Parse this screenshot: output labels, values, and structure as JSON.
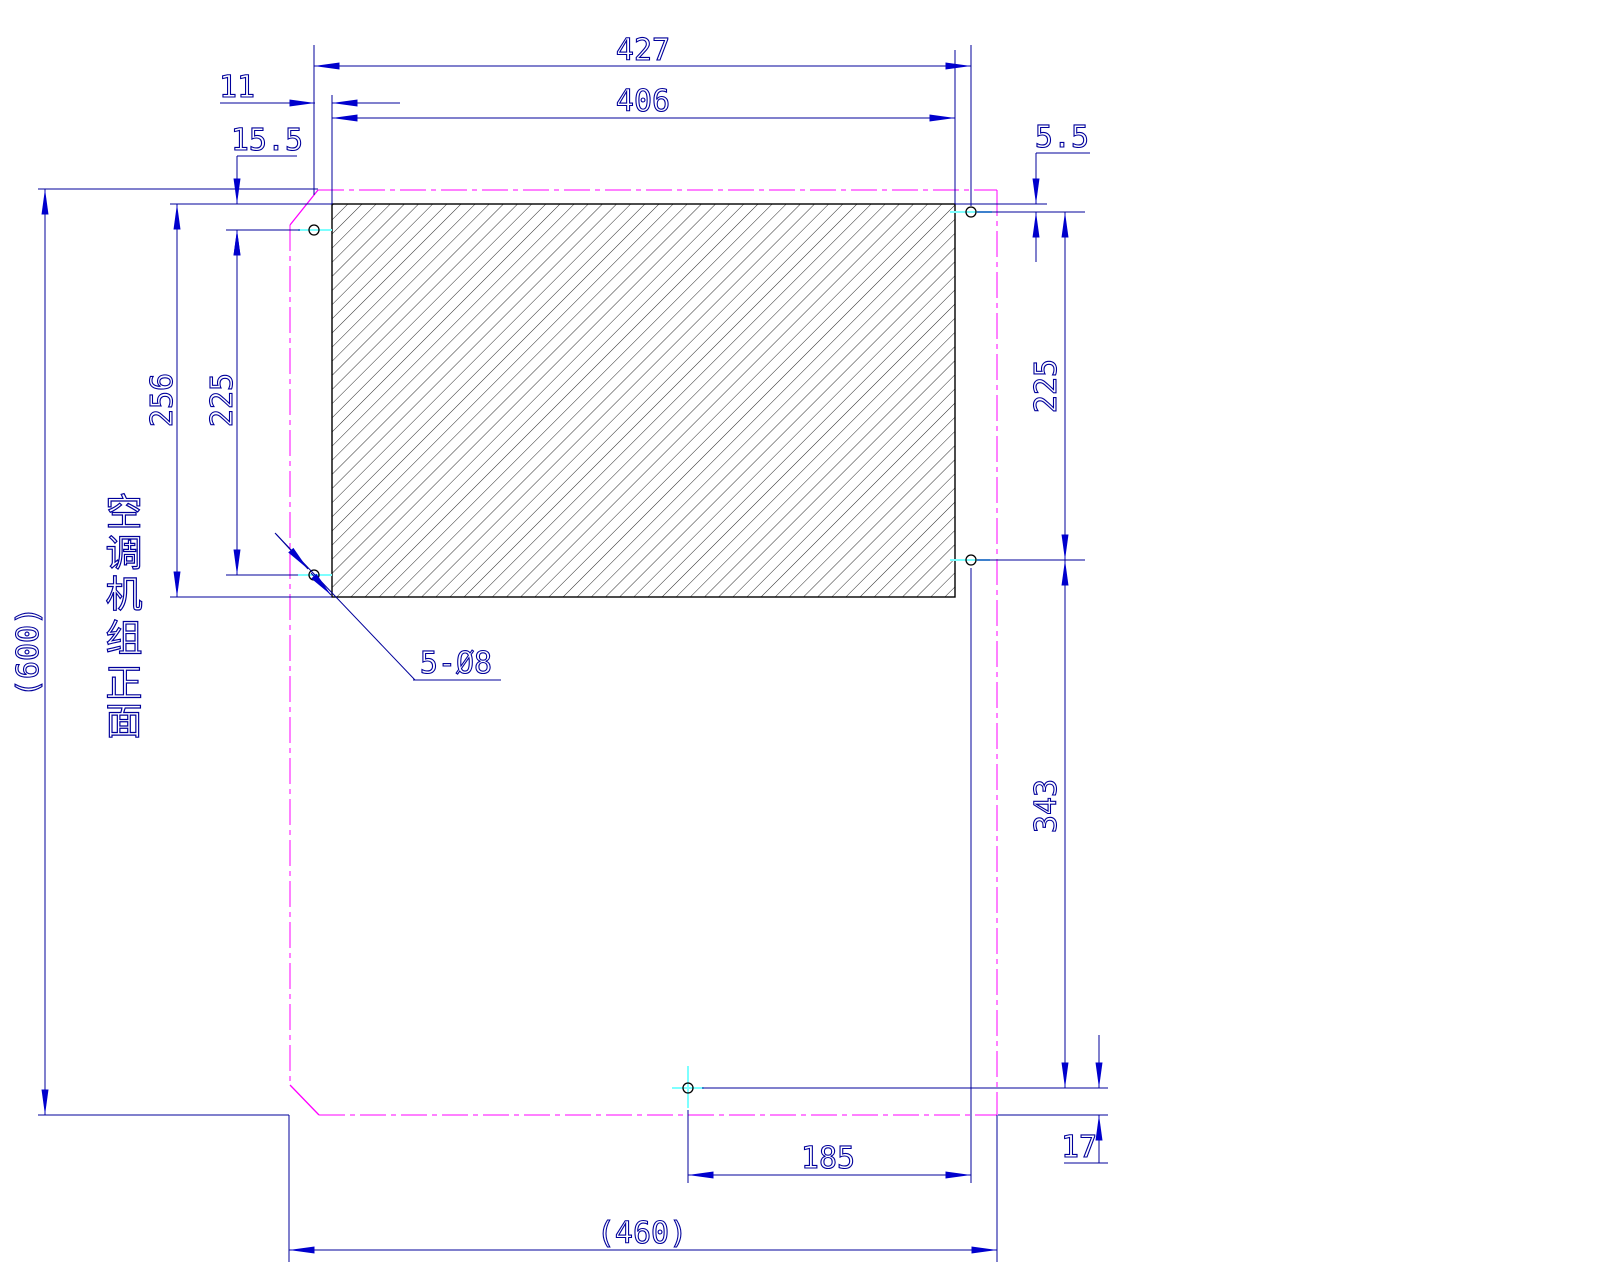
{
  "colors": {
    "dimension": "#00009b",
    "arrow": "#0000cd",
    "outline": "#ff00ff",
    "centerline": "#7dffff",
    "hatch": "#161616",
    "hole": "#000000",
    "background": "#ffffff"
  },
  "labels": {
    "d427": "427",
    "d406": "406",
    "d11": "11",
    "d15_5": "15.5",
    "d5_5": "5.5",
    "d256": "256",
    "d225_left": "225",
    "d225_right": "225",
    "d343": "343",
    "d185": "185",
    "d17": "17",
    "d460": "(460)",
    "d600": "(600)",
    "hole_note": "5-Ø8"
  },
  "side_label": {
    "text": "空调机组正面",
    "chars": [
      "空",
      "调",
      "机",
      "组",
      "正",
      "面"
    ]
  }
}
